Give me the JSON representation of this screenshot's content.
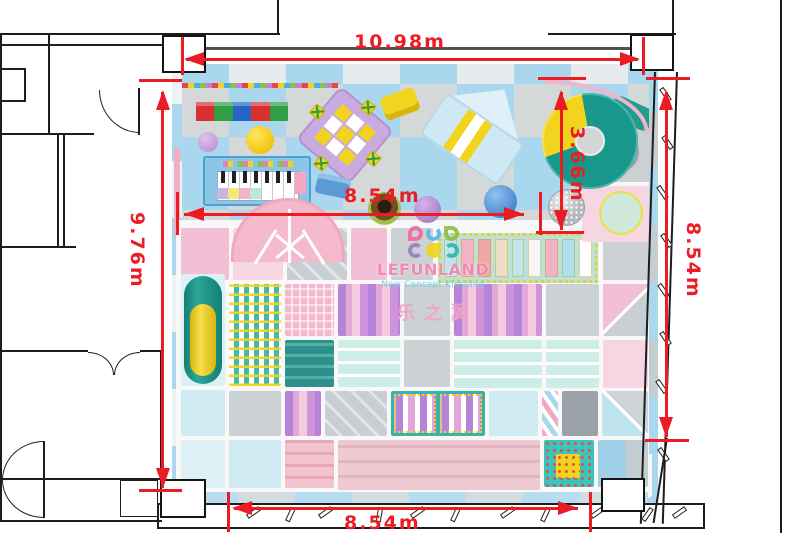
{
  "page": {
    "type": "floor-plan",
    "subject": "kids indoor playground top view"
  },
  "dimension_labels": {
    "top_width": "10.98m",
    "left_height": "9.76m",
    "play_area_width": "8.54m",
    "play_area_depth": "3.66m",
    "right_height": "8.54m",
    "bottom_width": "8.54m"
  },
  "watermark": {
    "brand": "LEFUNLAND",
    "tagline": "New Concept Kidsland",
    "chinese_name": "乐之翼"
  },
  "colors": {
    "dimension_red": "#ec1c24",
    "floor_blue": "#a9d8ee",
    "floor_gray": "#d5d8d8",
    "wall_black": "#1d1d1d",
    "logo_pink": "#f585b0",
    "logo_cyan": "#66d2e8"
  }
}
